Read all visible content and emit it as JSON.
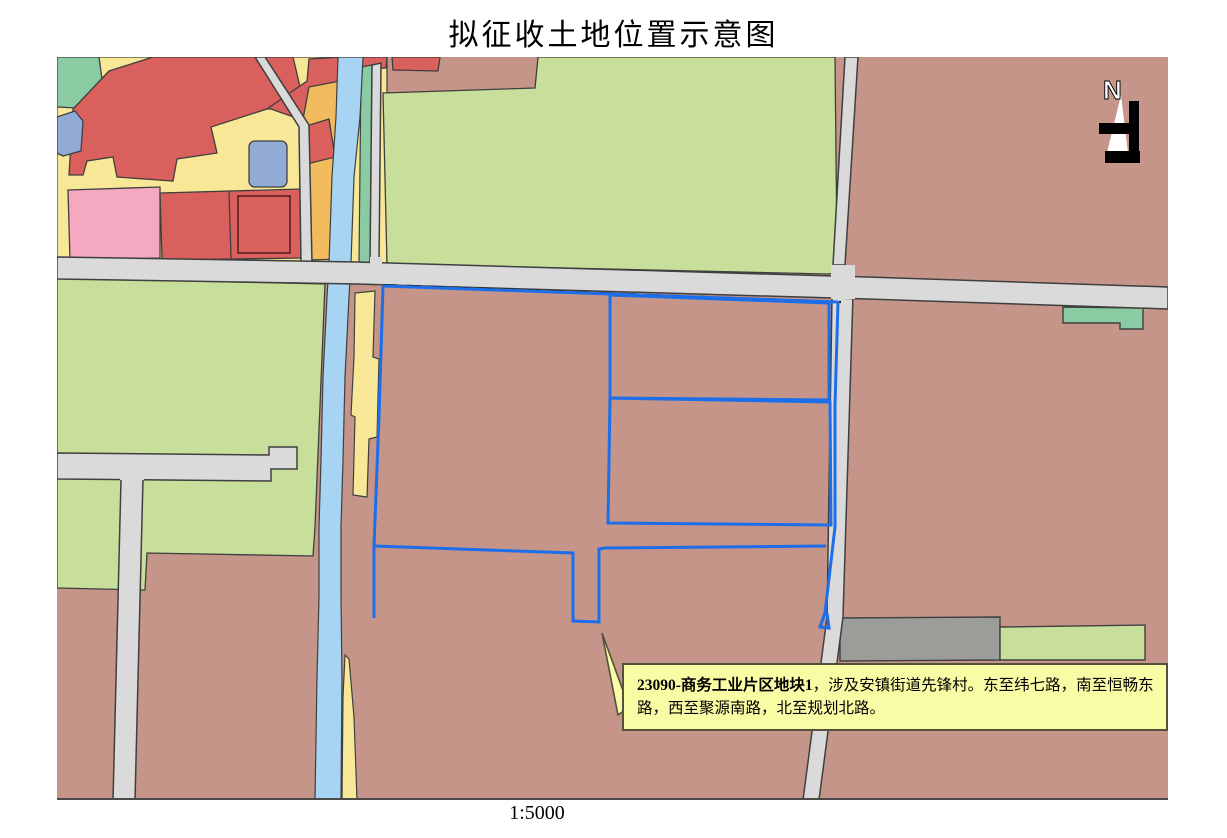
{
  "title": "拟征收土地位置示意图",
  "scale_label": "1:5000",
  "north_arrow": {
    "letter": "N"
  },
  "callout": {
    "bold_text": "23090-商务工业片区地块1",
    "rest_text": "，涉及安镇街道先锋村。东至纬七路，南至恒畅东路，西至聚源南路，北至规划北路。"
  },
  "colors": {
    "target_outline_blue": "#1c6fe8",
    "callout_fill": "#fafba5",
    "callout_border": "#52523d",
    "parcel_brown": "#c49588",
    "parcel_light_green": "#c8df9c",
    "parcel_teal": "#8bcba4",
    "parcel_yellow": "#f8e796",
    "parcel_orange": "#f2bc5e",
    "parcel_red": "#d9605c",
    "parcel_pink": "#f4a9c1",
    "parcel_bluegray": "#92abd6",
    "parcel_darkgray": "#9c9c98",
    "river_blue": "#a6d4f2",
    "road_gray": "#dadada",
    "outline_dark": "#3f3f3f"
  }
}
